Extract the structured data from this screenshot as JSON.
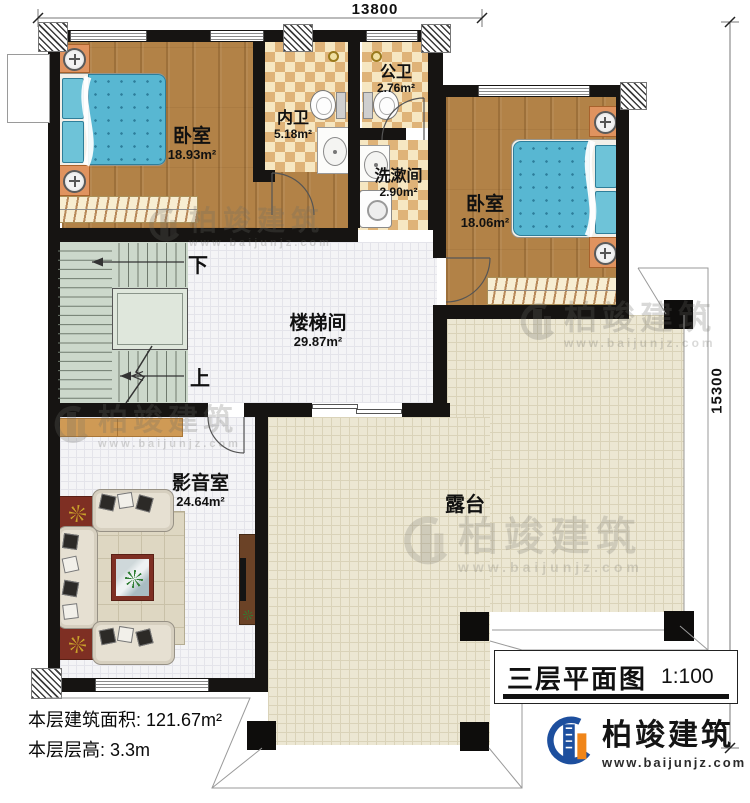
{
  "plan": {
    "drawing_type": "floor-plan",
    "dimensions": {
      "width_label": "13800",
      "height_label": "15300"
    },
    "rooms": {
      "bedroom_left": {
        "name": "卧室",
        "area": "18.93m²"
      },
      "inner_bath": {
        "name": "内卫",
        "area": "5.18m²"
      },
      "public_bath": {
        "name": "公卫",
        "area": "2.76m²"
      },
      "wash_room": {
        "name": "洗漱间",
        "area": "2.90m²"
      },
      "bedroom_right": {
        "name": "卧室",
        "area": "18.06m²"
      },
      "stair_hall": {
        "name": "楼梯间",
        "area": "29.87m²"
      },
      "media_room": {
        "name": "影音室",
        "area": "24.64m²"
      },
      "terrace": {
        "name": "露台"
      }
    },
    "stairs": {
      "down_label": "下",
      "up_label": "上"
    },
    "info": {
      "floor_area": "本层建筑面积: 121.67m²",
      "floor_height": "本层层高: 3.3m"
    },
    "title_block": {
      "title": "三层平面图",
      "scale": "1:100"
    },
    "brand": {
      "name": "柏竣建筑",
      "website": "www.baijunjz.com"
    },
    "watermark": {
      "name": "柏竣建筑",
      "website": "www.baijunjz.com"
    },
    "colors": {
      "wall": "#161412",
      "wood_floor": "#b28247",
      "bath_tile": "#dfb378",
      "terrace_tile": "#ece7d3",
      "stair": "#ccd8cb",
      "bed": "#58b7d2",
      "brand_blue": "#1d4f9e",
      "brand_orange": "#f08519"
    }
  }
}
